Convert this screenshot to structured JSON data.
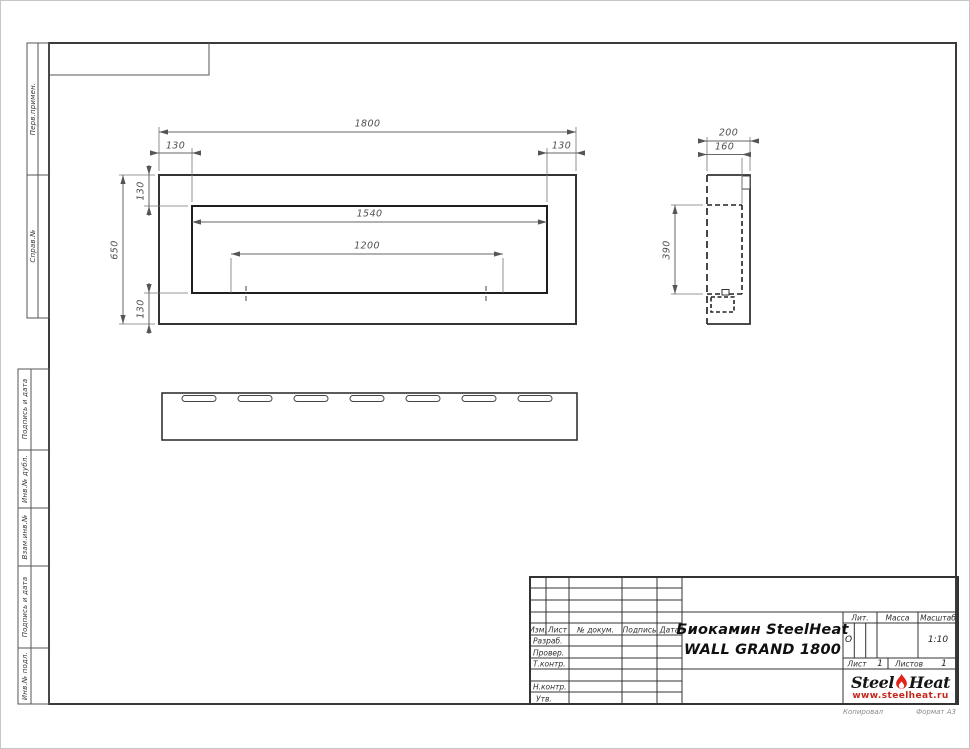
{
  "sheet": {
    "copied": "Копировал",
    "format": "Формат А3"
  },
  "left_margin": {
    "upper": [
      "Перв.примен.",
      "Справ.№"
    ],
    "lower": [
      "Подпись и дата",
      "Инв.№ дубл.",
      "Взам.инв.№",
      "Подпись и дата",
      "Инв.№ подл."
    ]
  },
  "front_view": {
    "width": "1800",
    "offset_left": "130",
    "offset_right": "130",
    "offset_top": "130",
    "height": "650",
    "offset_bottom": "130",
    "opening_width": "1540",
    "burner_span": "1200"
  },
  "side_view": {
    "depth": "200",
    "inner_depth": "160",
    "firebox_height": "390"
  },
  "title_block": {
    "col_izm": "Изм.",
    "col_list": "Лист",
    "col_doc": "№ докум.",
    "col_sign": "Подпись",
    "col_date": "Дата",
    "row_razrab": "Разраб.",
    "row_prover": "Провер.",
    "row_tkontr": "Т.контр.",
    "row_nkontr": "Н.контр.",
    "row_utv": "Утв.",
    "doc_title_line1": "Биокамин SteelHeat",
    "doc_title_line2": "WALL GRAND 1800",
    "lit_label": "Лит.",
    "lit_value": "О",
    "mass_label": "Масса",
    "scale_label": "Масштаб",
    "scale_value": "1:10",
    "sheet_label": "Лист",
    "sheet_no": "1",
    "sheets_label": "Листов",
    "sheets_total": "1"
  },
  "logo": {
    "word1": "Steel",
    "word2": "Heat",
    "site": "www.steelheat.ru"
  },
  "colors": {
    "flame_red": "#e2231a",
    "site_red": "#c5271d"
  }
}
